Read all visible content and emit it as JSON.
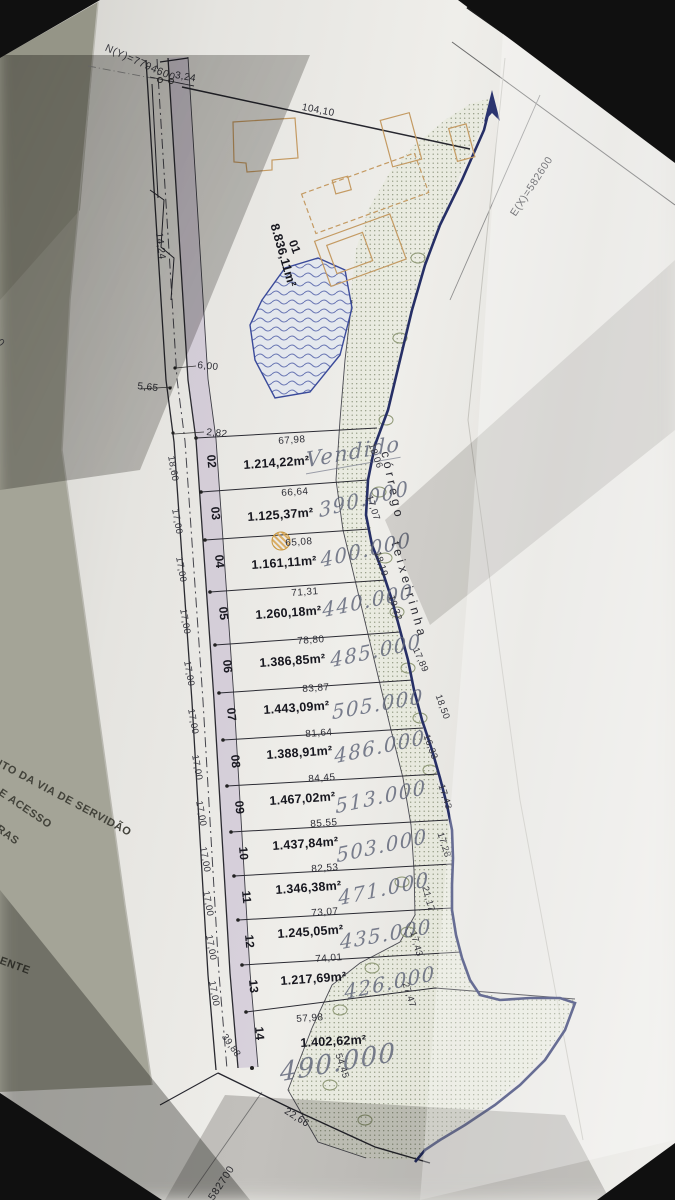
{
  "grid": {
    "north": "N(Y)=7794600",
    "east": "E(X)=582600",
    "south_partial": "582700",
    "west_partial": "00"
  },
  "stream": {
    "word1": "córrego",
    "word2": "teixeirinha"
  },
  "dims": {
    "top_boundary": "104,10",
    "tie": "3,24",
    "road": "14,24",
    "pond_a": "6,00",
    "pond_b": "5,65",
    "pond_c": "2,82"
  },
  "lot01": {
    "number": "01",
    "area": "8.836,11m²"
  },
  "lots": [
    {
      "number": "02",
      "front": "67,98",
      "area": "1.214,22m²",
      "note": "Vendido",
      "left": "18,60",
      "right": "18,06"
    },
    {
      "number": "03",
      "front": "66,64",
      "area": "1.125,37m²",
      "note": "390.000",
      "left": "17,00",
      "right": "17,07"
    },
    {
      "number": "04",
      "front": "65,08",
      "area": "1.161,11m²",
      "note": "400.000",
      "left": "17,00",
      "right": "18,19"
    },
    {
      "number": "05",
      "front": "71,31",
      "area": "1.260,18m²",
      "note": "440.000",
      "left": "17,00",
      "right": "19,32"
    },
    {
      "number": "06",
      "front": "78,80",
      "area": "1.386,85m²",
      "note": "485.000",
      "left": "17,00",
      "right": "17,89"
    },
    {
      "number": "07",
      "front": "83,87",
      "area": "1.443,09m²",
      "note": "505.000",
      "left": "17,00",
      "right": "18,50"
    },
    {
      "number": "08",
      "front": "81,64",
      "area": "1.388,91m²",
      "note": "486.000",
      "left": "17,00",
      "right": "16,33"
    },
    {
      "number": "09",
      "front": "84,45",
      "area": "1.467,02m²",
      "note": "513.000",
      "left": "17,00",
      "right": "17,43"
    },
    {
      "number": "10",
      "front": "85,55",
      "area": "1.437,84m²",
      "note": "503.000",
      "left": "17,00",
      "right": "17,28"
    },
    {
      "number": "11",
      "front": "82,53",
      "area": "1.346,38m²",
      "note": "471.000",
      "left": "17,00",
      "right": "21,17"
    },
    {
      "number": "12",
      "front": "73,07",
      "area": "1.245,05m²",
      "note": "435.000",
      "left": "17,00",
      "right": "17,43"
    },
    {
      "number": "13",
      "front": "74,01",
      "area": "1.217,69m²",
      "note": "426.000",
      "left": "17,00",
      "right": "27,47"
    },
    {
      "number": "14",
      "front": "57,98",
      "area": "1.402,62m²",
      "note": "490.000",
      "left": "39,88",
      "right": "54,45",
      "bottom": "22,66"
    }
  ],
  "margin_notes": {
    "l1": "ENTO DA VIA DE SERVIDÃO",
    "l2": "DE ACESSO",
    "l3": "ARAS",
    "l4": "NENTE"
  },
  "colors": {
    "stream_ink": "#262f66",
    "stipple": "#6d775b",
    "road_band": "#b4a3c6",
    "building": "#c49a62",
    "handwriting": "#5e6478",
    "ink": "#1d1d26"
  }
}
